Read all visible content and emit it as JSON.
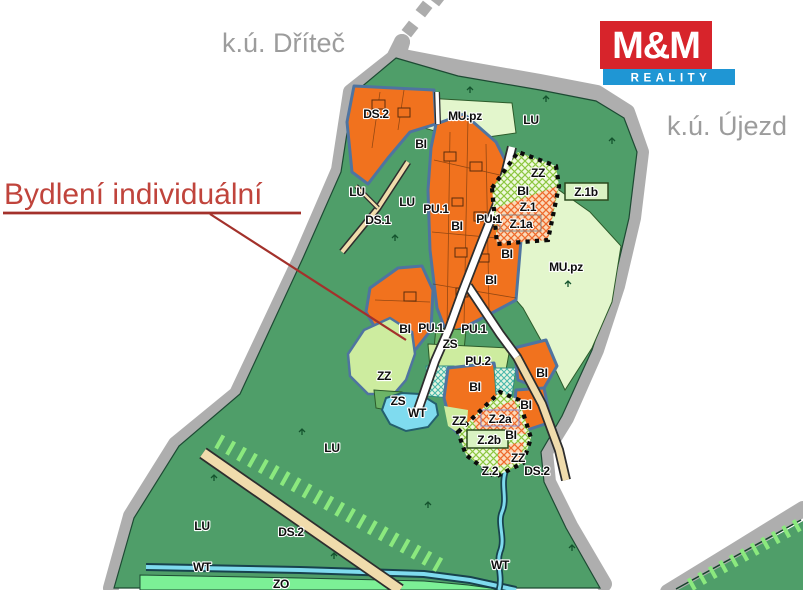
{
  "header": {
    "cadastre_left": "k.ú. Dříteč",
    "cadastre_right": "k.ú. Újezd"
  },
  "callout": {
    "text": "Bydlení individuální"
  },
  "logo": {
    "title": "M&M",
    "subtitle": "REALITY",
    "red": "#D7242B",
    "blue": "#1F96D4"
  },
  "colors": {
    "bi_orange": "#F1721E",
    "lu_green": "#4F9E69",
    "zz_light_green": "#CDEC9F",
    "mu_pale_green": "#E3F6CC",
    "zs_green": "#6CB467",
    "zo_bright_green": "#7CF096",
    "wt_cyan": "#7FDBEF",
    "road_tan": "#F0DCAC",
    "cadastre_band_gray": "#AEAEAE",
    "built_boundary_blue": "#4F74A0",
    "development_label_pink": "#E0559E",
    "annotation_red": "#C0443C"
  },
  "zone_labels": [
    {
      "t": "DS.2",
      "x": 376,
      "y": 118
    },
    {
      "t": "MU.pz",
      "x": 465,
      "y": 120
    },
    {
      "t": "LU",
      "x": 531,
      "y": 124
    },
    {
      "t": "BI",
      "x": 421,
      "y": 148
    },
    {
      "t": "ZZ",
      "x": 538,
      "y": 177
    },
    {
      "t": "BI",
      "x": 523,
      "y": 195
    },
    {
      "t": "Z.1",
      "x": 528,
      "y": 211,
      "s": 20
    },
    {
      "t": "Z.1a",
      "x": 521,
      "y": 228,
      "c": "#E0559E"
    },
    {
      "t": "Z.1b",
      "x": 586,
      "y": 196,
      "c": "#E0559E"
    },
    {
      "t": "LU",
      "x": 357,
      "y": 196
    },
    {
      "t": "LU",
      "x": 407,
      "y": 206
    },
    {
      "t": "PU.1",
      "x": 436,
      "y": 213
    },
    {
      "t": "DS.1",
      "x": 378,
      "y": 224
    },
    {
      "t": "BI",
      "x": 457,
      "y": 230
    },
    {
      "t": "PU.1",
      "x": 489,
      "y": 223
    },
    {
      "t": "BI",
      "x": 507,
      "y": 258
    },
    {
      "t": "BI",
      "x": 491,
      "y": 284
    },
    {
      "t": "MU.pz",
      "x": 566,
      "y": 271,
      "s": 14
    },
    {
      "t": "BI",
      "x": 405,
      "y": 333
    },
    {
      "t": "PU.1",
      "x": 431,
      "y": 332
    },
    {
      "t": "PU.1",
      "x": 474,
      "y": 333
    },
    {
      "t": "ZS",
      "x": 450,
      "y": 348
    },
    {
      "t": "PU.2",
      "x": 478,
      "y": 365
    },
    {
      "t": "ZZ",
      "x": 384,
      "y": 380
    },
    {
      "t": "ZS",
      "x": 398,
      "y": 405
    },
    {
      "t": "WT",
      "x": 417,
      "y": 417
    },
    {
      "t": "BI",
      "x": 475,
      "y": 391
    },
    {
      "t": "ZZ",
      "x": 459,
      "y": 425
    },
    {
      "t": "BI",
      "x": 542,
      "y": 377
    },
    {
      "t": "BI",
      "x": 526,
      "y": 409
    },
    {
      "t": "Z.2a",
      "x": 500,
      "y": 423,
      "c": "#E0559E"
    },
    {
      "t": "BI",
      "x": 511,
      "y": 439
    },
    {
      "t": "Z.2b",
      "x": 489,
      "y": 444,
      "c": "#E0559E"
    },
    {
      "t": "ZZ",
      "x": 518,
      "y": 462
    },
    {
      "t": "Z.2",
      "x": 490,
      "y": 475,
      "s": 20
    },
    {
      "t": "DS.2",
      "x": 537,
      "y": 475
    },
    {
      "t": "LU",
      "x": 332,
      "y": 452
    },
    {
      "t": "LU",
      "x": 202,
      "y": 530
    },
    {
      "t": "DS.2",
      "x": 291,
      "y": 536
    },
    {
      "t": "WT",
      "x": 202,
      "y": 571
    },
    {
      "t": "ZO",
      "x": 281,
      "y": 588
    },
    {
      "t": "WT",
      "x": 500,
      "y": 569
    }
  ],
  "tree_symbols": [
    [
      470,
      90
    ],
    [
      546,
      99
    ],
    [
      612,
      141
    ],
    [
      568,
      284
    ],
    [
      395,
      238
    ],
    [
      302,
      432
    ],
    [
      428,
      505
    ],
    [
      572,
      548
    ],
    [
      214,
      478
    ],
    [
      334,
      556
    ]
  ]
}
